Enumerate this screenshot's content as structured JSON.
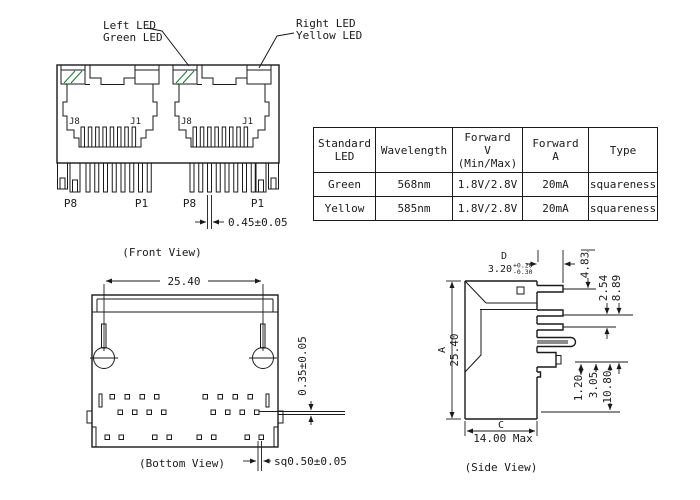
{
  "front_view": {
    "caption": "(Front View)",
    "left_led_label_1": "Left LED",
    "left_led_label_2": "Green LED",
    "right_led_label_1": "Right LED",
    "right_led_label_2": "Yellow LED",
    "j8": "J8",
    "j1": "J1",
    "p8": "P8",
    "p1": "P1",
    "pin_width_dim": "0.45±0.05"
  },
  "bottom_view": {
    "caption": "(Bottom View)",
    "width_dim": "25.40",
    "pin_offset_dim": "0.35±0.05",
    "pin_square_dim": "sq0.50±0.05"
  },
  "side_view": {
    "caption": "(Side View)",
    "dim_d_letter": "D",
    "dim_d_value": "3.20",
    "dim_d_tol_plus": "+0.20",
    "dim_d_tol_minus": "-0.30",
    "dim_a_letter": "A",
    "dim_a_value": "25.40",
    "dim_c_letter": "C",
    "dim_c_value": "14.00 Max",
    "dim_4_83": "4.83",
    "dim_2_54": "2.54",
    "dim_8_89": "8.89",
    "dim_1_20": "1.20",
    "dim_3_05": "3.05",
    "dim_10_80": "10.80"
  },
  "led_table": {
    "headers": [
      "Standard\nLED",
      "Wavelength",
      "Forward\nV\n(Min/Max)",
      "Forward\nA",
      "Type"
    ],
    "rows": [
      [
        "Green",
        "568nm",
        "1.8V/2.8V",
        "20mA",
        "squareness"
      ],
      [
        "Yellow",
        "585nm",
        "1.8V/2.8V",
        "20mA",
        "squareness"
      ]
    ]
  },
  "colors": {
    "led_green": "#1da23c",
    "led_yellow": "#f5eb00",
    "line": "#1a1a1a"
  }
}
